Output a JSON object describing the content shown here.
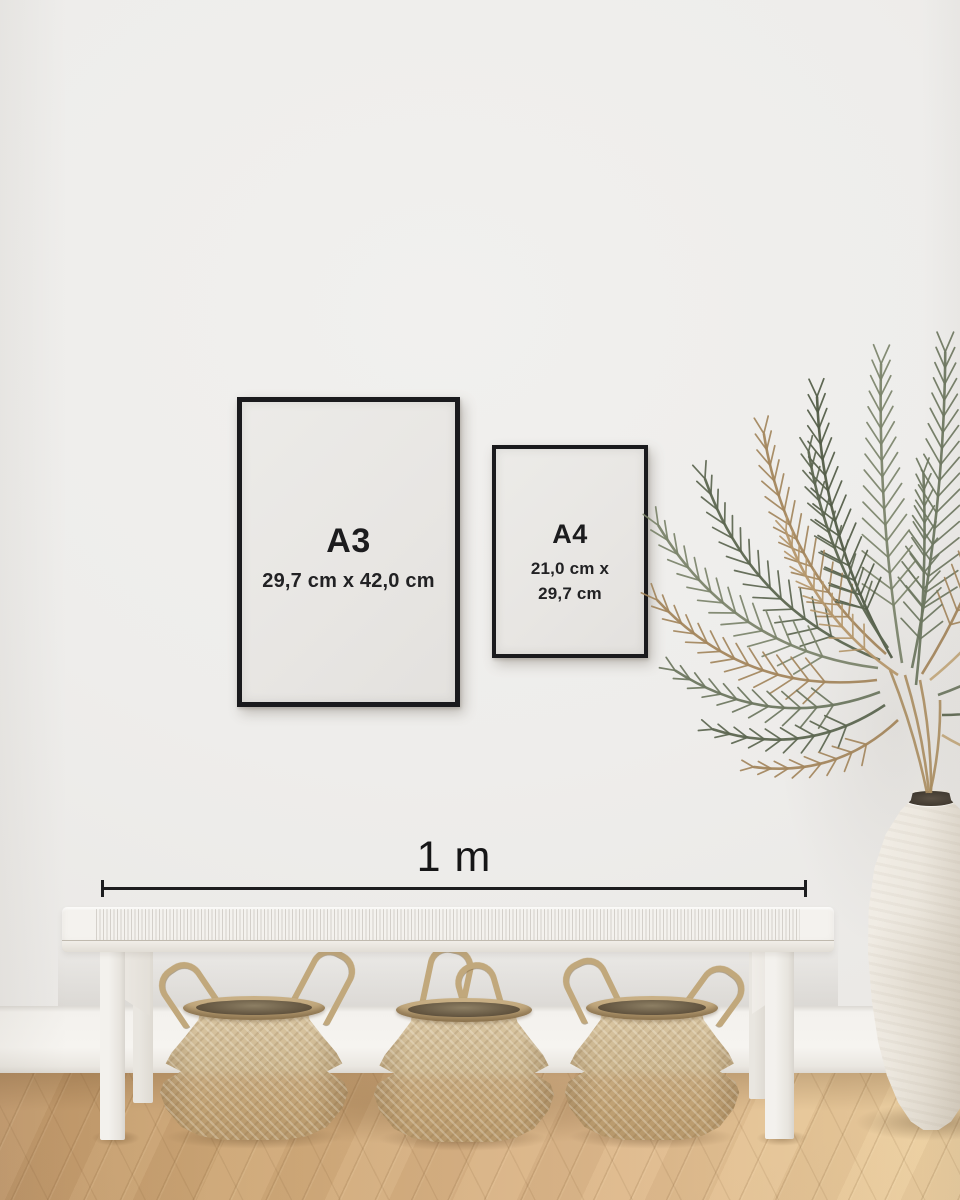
{
  "frames": [
    {
      "label": "A3",
      "dimensions": [
        "29,7 cm x 42,0 cm"
      ]
    },
    {
      "label": "A4",
      "dimensions": [
        "21,0 cm x",
        "29,7 cm"
      ]
    }
  ],
  "ruler": {
    "label": "1 m"
  },
  "colors": {
    "frame_border": "#1a1a1d",
    "text_dark": "#1c1c1e",
    "wall": "#eeedeb",
    "baseboard": "#f5f3ef",
    "floor_dark": "#c0976a",
    "floor_light": "#eed2a4",
    "bench_white": "#f4f2ee",
    "basket_tan": "#c9ae82",
    "vase_white": "#ece7de",
    "plant_greens": [
      "#6d7760",
      "#5c6650",
      "#7b846b",
      "#525c47"
    ],
    "plant_browns": [
      "#b5976b",
      "#a3865d",
      "#c2a87c"
    ]
  }
}
